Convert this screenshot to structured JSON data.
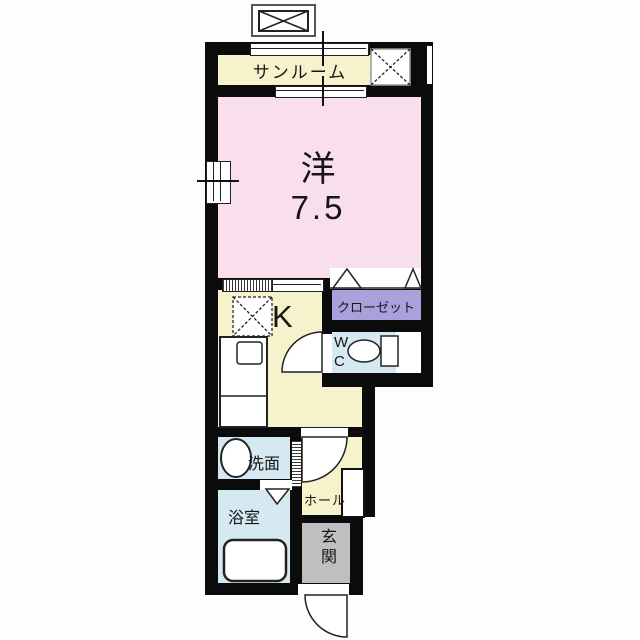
{
  "plan": {
    "type": "apartment-floor-plan-1K",
    "rooms": {
      "sunroom": {
        "label": "サンルーム"
      },
      "western_room": {
        "label": "洋",
        "size": "7.5"
      },
      "closet": {
        "label": "クローゼット"
      },
      "kitchen": {
        "label": "K"
      },
      "wc": {
        "label": "WC"
      },
      "washroom": {
        "label": "洗面"
      },
      "hall": {
        "label": "ホール"
      },
      "bathroom": {
        "label": "浴室"
      },
      "entrance": {
        "label": "玄関"
      }
    },
    "fixtures": [
      "toilet-icon",
      "toilet-tank-icon",
      "bathtub-icon",
      "washbasin-icon",
      "kitchen-counter-icon",
      "kitchen-sink-icon",
      "refrigerator-space-icon",
      "washer-space-icon",
      "outdoor-unit-box-icon",
      "shoe-cabinet-icon",
      "door-swing-arc-icon",
      "folding-door-icon",
      "sliding-window-icon"
    ],
    "colors": {
      "western_room": "#F9DFED",
      "cream_floor": "#F6F2CB",
      "closet": "#A9A1DB",
      "wet_area": "#D4E9F2",
      "entrance": "#C0BFBF",
      "wall": "#0B0B0B",
      "background": "#FFFFFF"
    }
  }
}
